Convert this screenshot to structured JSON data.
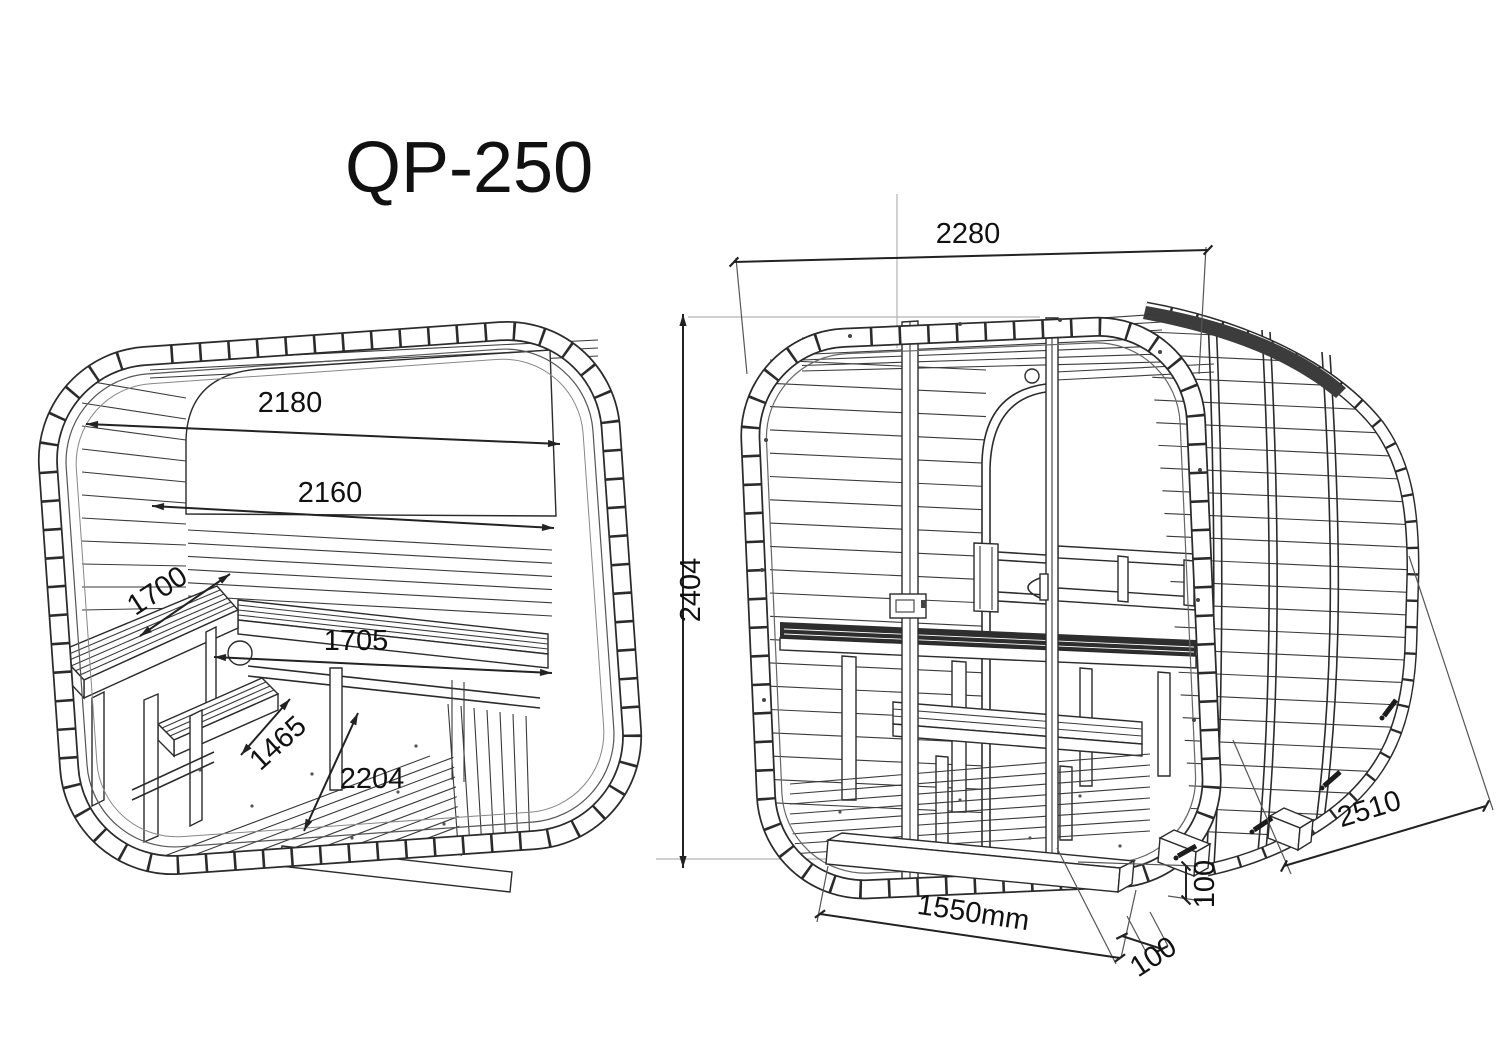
{
  "title": "QP-250",
  "views": {
    "interior": {
      "name": "Interior cutaway view",
      "dims": {
        "top_width": "2180",
        "wall_width": "2160",
        "side_bench_depth": "1700",
        "back_bench_length": "1705",
        "step_bench_length": "1465",
        "floor_diagonal": "2204"
      }
    },
    "exterior": {
      "name": "Exterior front view",
      "dims": {
        "overall_width": "2280",
        "overall_height": "2404",
        "overall_depth": "2510",
        "base_length": "1550mm",
        "base_beam_height": "100",
        "base_beam_width": "100"
      }
    }
  },
  "colors": {
    "line": "#2b2b2b",
    "reference_line": "#b3b3b3",
    "background": "#ffffff",
    "dark_fill": "#363636"
  }
}
